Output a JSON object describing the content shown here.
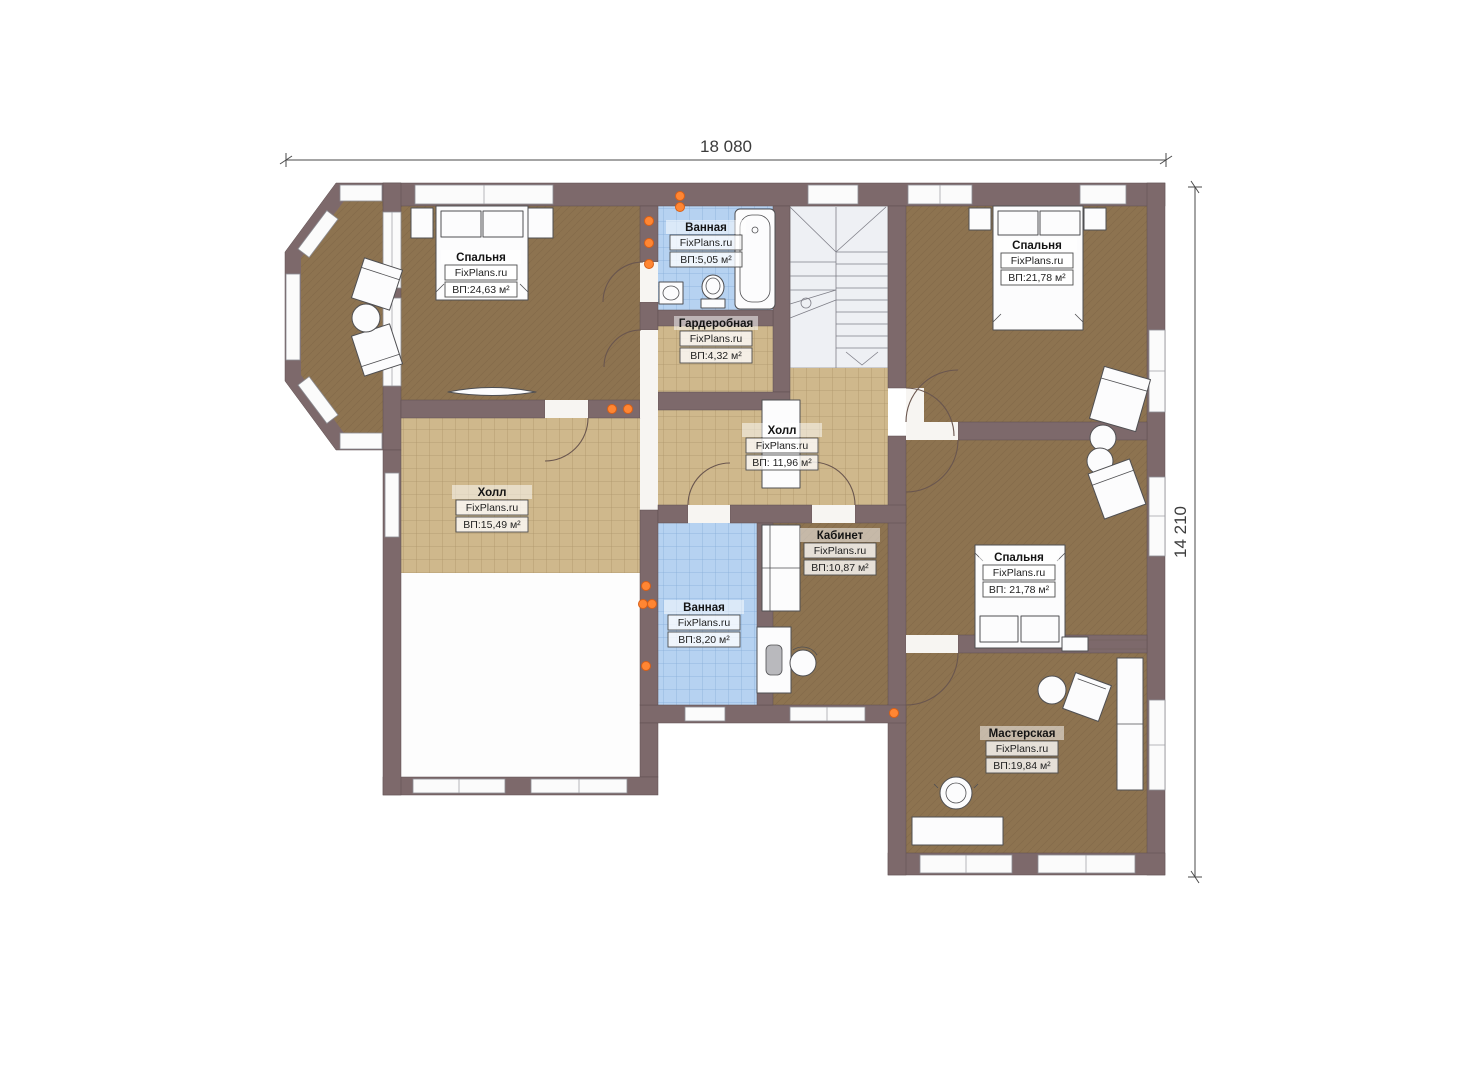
{
  "plan_title": "Second floor plan",
  "dimensions": {
    "width_label": "18 080",
    "height_label": "14 210"
  },
  "rooms": [
    {
      "id": "bedroom-1",
      "name": "Спальня",
      "brand": "FixPlans.ru",
      "area": "ВП:24,63 м²"
    },
    {
      "id": "bathroom-1",
      "name": "Ванная",
      "brand": "FixPlans.ru",
      "area": "ВП:5,05 м²"
    },
    {
      "id": "wardrobe",
      "name": "Гардеробная",
      "brand": "FixPlans.ru",
      "area": "ВП:4,32 м²"
    },
    {
      "id": "bedroom-top-right",
      "name": "Спальня",
      "brand": "FixPlans.ru",
      "area": "ВП:21,78 м²"
    },
    {
      "id": "hall-middle",
      "name": "Холл",
      "brand": "FixPlans.ru",
      "area": "ВП: 11,96 м²"
    },
    {
      "id": "hall-left",
      "name": "Холл",
      "brand": "FixPlans.ru",
      "area": "ВП:15,49 м²"
    },
    {
      "id": "office",
      "name": "Кабинет",
      "brand": "FixPlans.ru",
      "area": "ВП:10,87 м²"
    },
    {
      "id": "bathroom-2",
      "name": "Ванная",
      "brand": "FixPlans.ru",
      "area": "ВП:8,20 м²"
    },
    {
      "id": "bedroom-mid-right",
      "name": "Спальня",
      "brand": "FixPlans.ru",
      "area": "ВП: 21,78 м²"
    },
    {
      "id": "workshop",
      "name": "Мастерская",
      "brand": "FixPlans.ru",
      "area": "ВП:19,84 м²"
    }
  ],
  "colors": {
    "wall": "#7d696b",
    "floor_carpet_brown": "#8d7350",
    "floor_tile_tan": "#cfb88c",
    "floor_tile_blue": "#b6d2f1",
    "stairs": "#eef0f4",
    "socket_marker": "#ff8633"
  }
}
